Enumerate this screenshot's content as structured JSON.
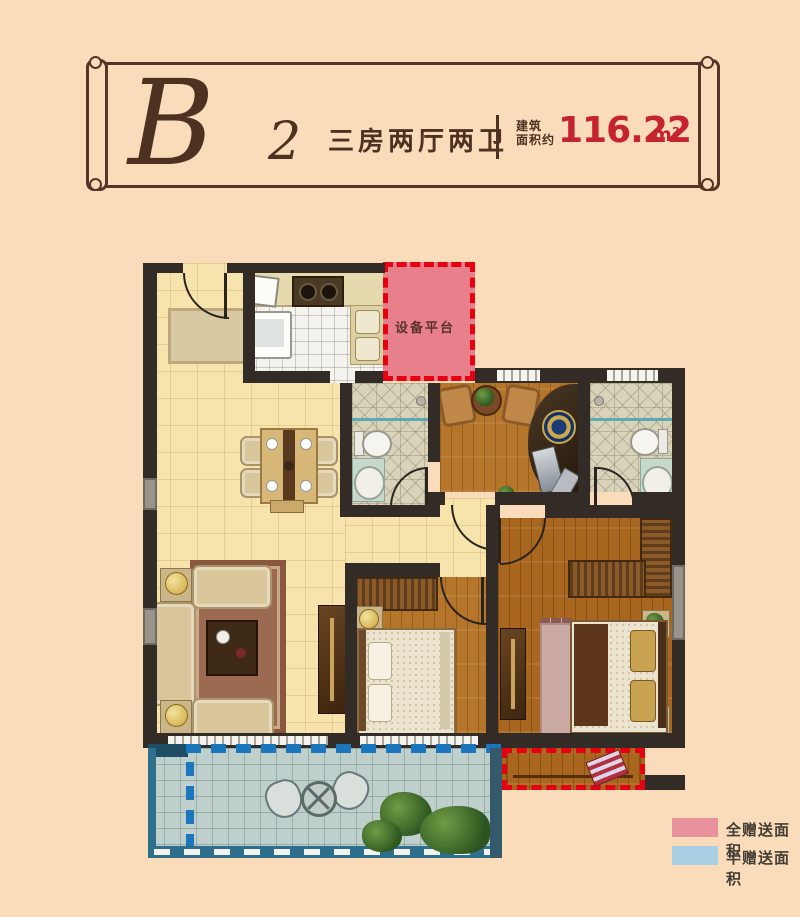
{
  "header": {
    "plan_letter": "B",
    "plan_number": "2",
    "layout_text": "三房两厅两卫",
    "area_label_line1": "建筑",
    "area_label_line2": "面积约",
    "area_value": "116.22",
    "area_unit": "m²"
  },
  "plan": {
    "equipment_platform_label": "设备平台"
  },
  "legend": {
    "items": [
      {
        "label": "全赠送面积",
        "color": "#e8929c"
      },
      {
        "label": "半赠送面积",
        "color": "#a9cfe4"
      }
    ]
  },
  "palette": {
    "background": "#fbdcba",
    "banner_border": "#543528",
    "text_brown": "#4d3222",
    "area_red": "#c5232e",
    "wall_dark": "#332c26",
    "gift_full_fill": "#e8808b",
    "gift_red": "#e60012",
    "gift_half_blue": "#1b76be",
    "living_floor": "#f7e3ac",
    "wood_floor": "#b5762c",
    "master_floor": "#a8661f",
    "bath_floor": "#d8d3b9",
    "kitchen_floor": "#f4f3ee",
    "balcony_floor": "#bfcfcb",
    "balcony_wall": "#2e6f8e",
    "legend_pink": "#e8929c",
    "legend_blue": "#a9cfe4"
  }
}
